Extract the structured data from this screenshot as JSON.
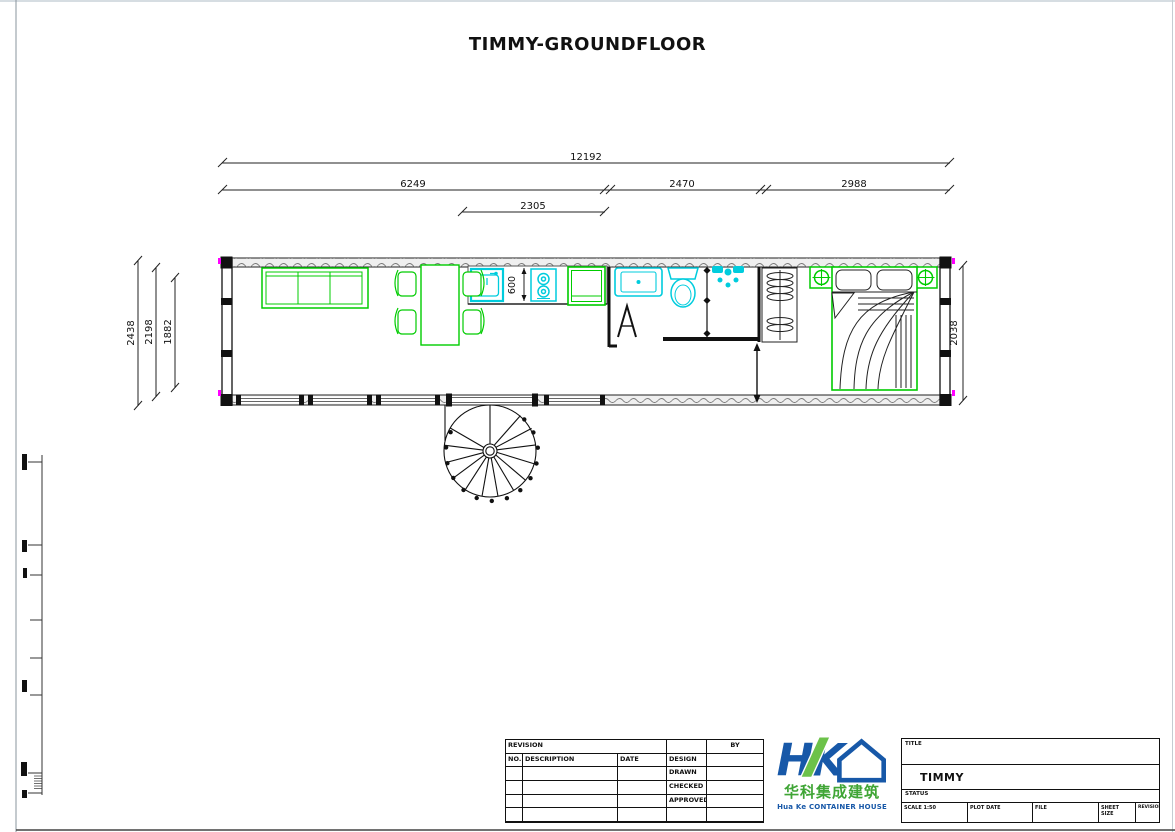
{
  "sheet": {
    "title": "TIMMY-GROUNDFLOOR"
  },
  "dimensions": {
    "overall_length": "12192",
    "living_length": "6249",
    "bath_length": "2470",
    "bedroom_length": "2988",
    "kitchen_length": "2305",
    "overall_width": "2438",
    "inner_width": "2198",
    "room_width": "1882",
    "bedroom_width": "2038",
    "counter_depth": "600"
  },
  "revision_table": {
    "title": "REVISION",
    "col_no": "NO.",
    "col_description": "DESCRIPTION",
    "col_date": "DATE",
    "col_by": "BY",
    "row_design": "DESIGN",
    "row_drawn": "DRAWN",
    "row_checked": "CHECKED",
    "row_approved": "APPROVED"
  },
  "logo": {
    "monogram": "HK",
    "company_cn": "华科集成建筑",
    "company_en": "Hua Ke CONTAINER HOUSE"
  },
  "title_block": {
    "title_label": "TITLE",
    "project": "TIMMY",
    "status_label": "STATUS",
    "field_scale": "SCALE  1:50",
    "field_plot_date": "PLOT DATE",
    "field_file": "FILE",
    "field_sheet_size": "SHEET SIZE",
    "field_revision": "REVISION"
  },
  "colors": {
    "furniture_green": "#00cc00",
    "fixture_cyan": "#00ccdd",
    "corner_magenta": "#ff00ff",
    "logo_blue": "#1758a8",
    "logo_green": "#6cc24a"
  }
}
